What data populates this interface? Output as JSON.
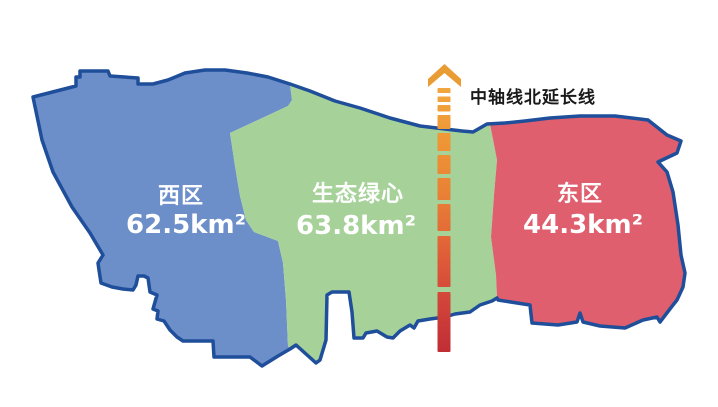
{
  "map": {
    "background": "#ffffff",
    "outline_color": "#1f4e9a",
    "regions": [
      {
        "id": "west",
        "label": "西区",
        "area": "62.5km²",
        "color": "#6c8fc9"
      },
      {
        "id": "green-heart",
        "label": "生态绿心",
        "area": "63.8km²",
        "color": "#a6d299"
      },
      {
        "id": "east",
        "label": "东区",
        "area": "44.3km²",
        "color": "#df5f6e"
      }
    ]
  },
  "axis": {
    "label": "中轴线北延长线",
    "label_color": "#1a1a1a",
    "direction": "north",
    "arrow_color": "#e99c33",
    "gradient_top": "#f2a63e",
    "gradient_bottom": "#c02e35"
  }
}
